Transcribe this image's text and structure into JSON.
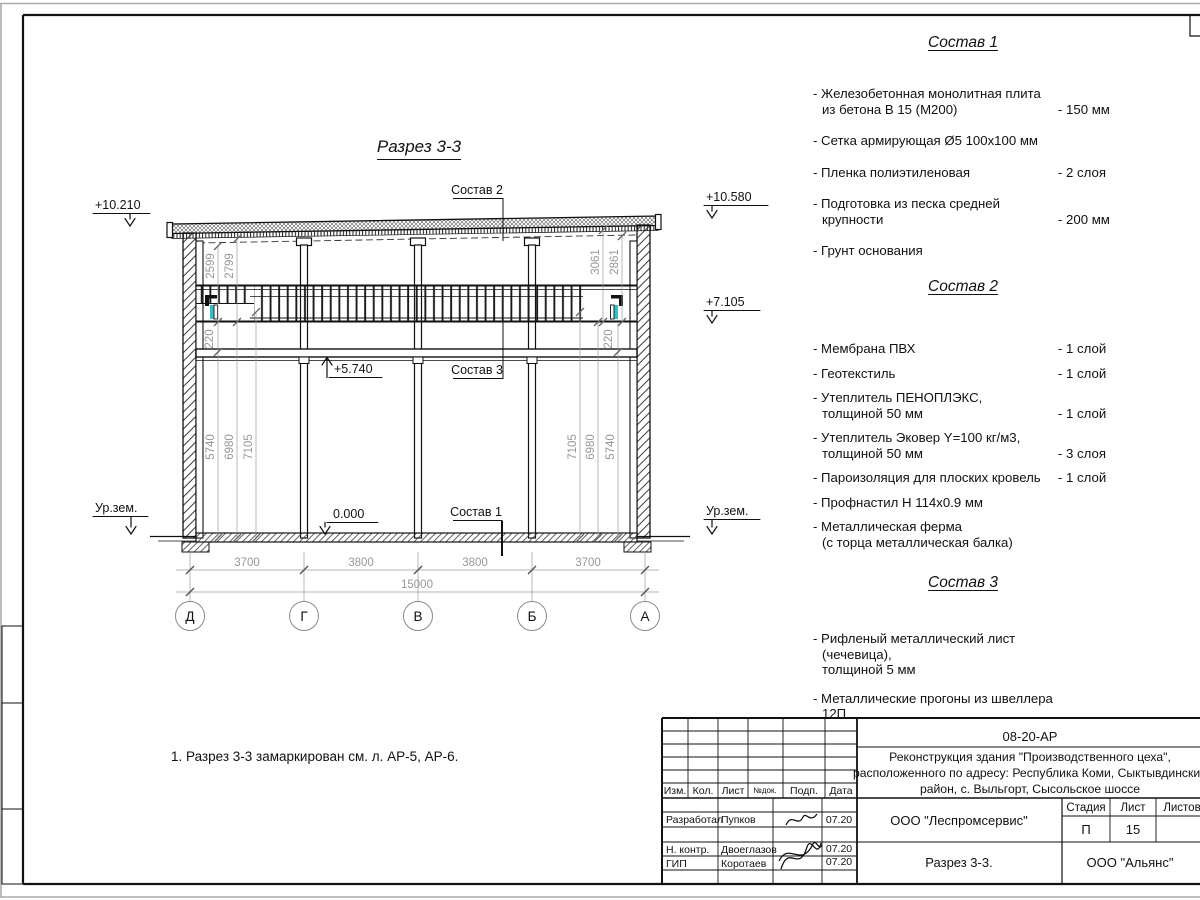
{
  "drawing": {
    "title": "Разрез 3-3",
    "axes": [
      "Д",
      "Г",
      "В",
      "Б",
      "А"
    ],
    "dims_bottom": [
      "3700",
      "3800",
      "3800",
      "3700"
    ],
    "dim_total": "15000",
    "dims_left_top": [
      "2599",
      "2799"
    ],
    "dims_right_top": [
      "3061",
      "2861"
    ],
    "dims_left": [
      "5740",
      "6980",
      "7105"
    ],
    "dims_right": [
      "7105",
      "6980",
      "5740"
    ],
    "dim_band_left": "220",
    "dim_band_right": "220",
    "elev_left_top": "+10.210",
    "elev_right_top": "+10.580",
    "elev_right_mid": "+7.105",
    "elev_mezzanine": "+5.740",
    "elev_floor": "0.000",
    "ground_left": "Ур.зем.",
    "ground_right": "Ур.зем.",
    "callout_1": "Состав 1",
    "callout_2": "Состав 2",
    "callout_3": "Состав 3"
  },
  "specs": [
    {
      "title": "Состав 1",
      "items": [
        {
          "name": "- Железобетонная  монолитная плита\nиз бетона В 15 (М200)",
          "value": "- 150 мм"
        },
        {
          "name": "- Сетка армирующая Ø5 100x100 мм",
          "value": ""
        },
        {
          "name": "- Пленка полиэтиленовая",
          "value": "- 2 слоя"
        },
        {
          "name": "- Подготовка из песка средней\nкрупности",
          "value": "- 200 мм"
        },
        {
          "name": "- Грунт основания",
          "value": ""
        }
      ]
    },
    {
      "title": "Состав 2",
      "items": [
        {
          "name": "- Мембрана ПВХ",
          "value": "- 1 слой"
        },
        {
          "name": "- Геотекстиль",
          "value": "- 1 слой"
        },
        {
          "name": "- Утеплитель ПЕНОПЛЭКС,\nтолщиной 50 мм",
          "value": "- 1 слой"
        },
        {
          "name": "- Утеплитель Эковер Y=100 кг/м3,\nтолщиной 50 мм",
          "value": "- 3 слоя"
        },
        {
          "name": "- Пароизоляция для плоских кровель",
          "value": "- 1 слой"
        },
        {
          "name": "- Профнастил Н 114x0.9 мм",
          "value": ""
        },
        {
          "name": "- Металлическая ферма\n(с торца металлическая балка)",
          "value": ""
        }
      ]
    },
    {
      "title": "Состав 3",
      "items": [
        {
          "name": "- Рифленый металлический лист (чечевица),\nтолщиной 5 мм",
          "value": ""
        },
        {
          "name": "- Металлические прогоны из швеллера 12П",
          "value": ""
        }
      ]
    }
  ],
  "note": "1. Разрез 3-3 замаркирован см. л. АР-5, АР-6.",
  "titleblock": {
    "doc_number": "08-20-АР",
    "project_line1": "Реконструкция здания \"Производственного цеха\",",
    "project_line2": "расположенного по адресу: Республика Коми, Сыктывдинский",
    "project_line3": "район, с. Выльгорт, Сысольское шоссе",
    "columns": [
      "Изм.",
      "Кол.",
      "Лист",
      "№док.",
      "Подп.",
      "Дата"
    ],
    "stage_label": "Стадия",
    "sheet_label": "Лист",
    "sheets_label": "Листов",
    "stage": "П",
    "sheet": "15",
    "org": "ООО \"Леспромсервис\"",
    "sheet_title": "Разрез 3-3.",
    "customer": "ООО \"Альянс\"",
    "roles": [
      {
        "role": "Разработал",
        "name": "Пупков",
        "date": "07.20"
      },
      {
        "role": "Н. контр.",
        "name": "Двоеглазов",
        "date": "07.20"
      },
      {
        "role": "ГИП",
        "name": "Коротаев",
        "date": "07.20"
      }
    ]
  },
  "colors": {
    "accent_cyan": "#35bfc6",
    "dim_gray": "#979797"
  }
}
